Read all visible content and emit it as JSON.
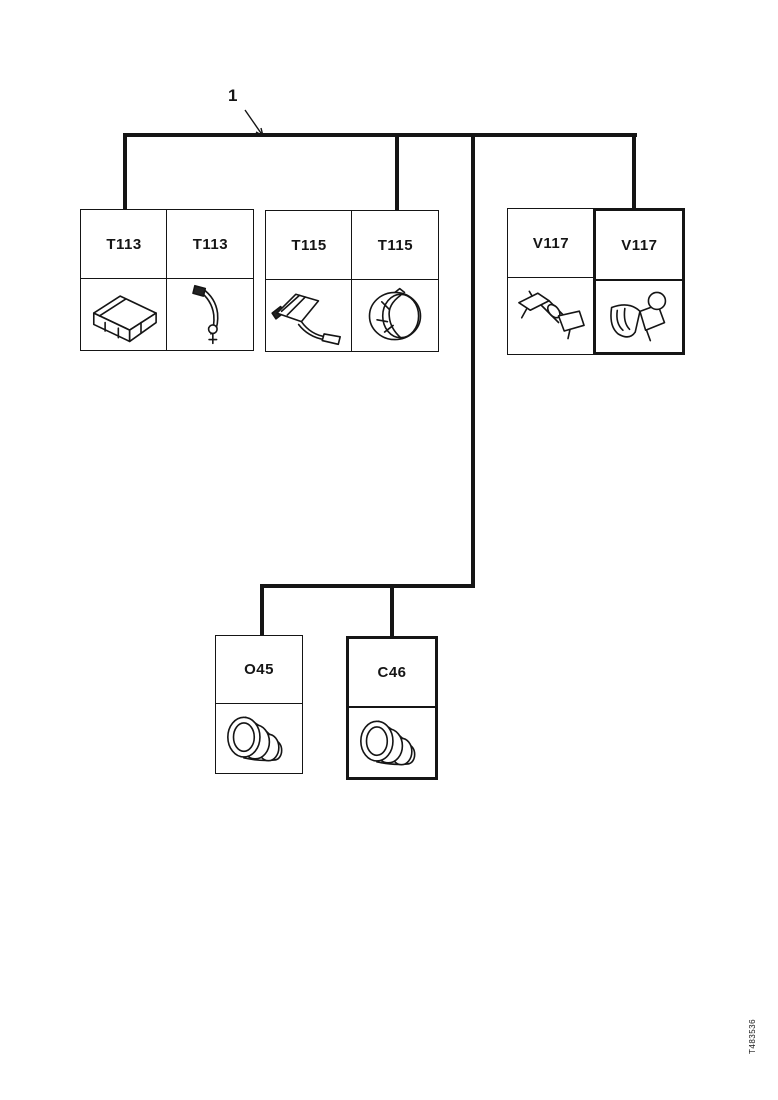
{
  "page": {
    "background": "#ffffff",
    "ink": "#151515"
  },
  "callout": {
    "label": "1"
  },
  "connector_groups": [
    {
      "name": "T113",
      "cells": [
        {
          "label": "T113",
          "icon": "rectangular-connector-icon"
        },
        {
          "label": "T113",
          "icon": "cable-sensor-icon"
        }
      ]
    },
    {
      "name": "T115",
      "cells": [
        {
          "label": "T115",
          "icon": "bracket-sensor-icon"
        },
        {
          "label": "T115",
          "icon": "round-connector-icon"
        }
      ]
    },
    {
      "name": "V117",
      "cells": [
        {
          "label": "V117",
          "icon": "valve-assembly-icon"
        },
        {
          "label": "V117",
          "icon": "solenoid-valve-icon"
        }
      ]
    }
  ],
  "lower_boxes": [
    {
      "label": "O45",
      "icon": "cylindrical-connector-icon"
    },
    {
      "label": "C46",
      "icon": "cylindrical-connector-icon"
    }
  ],
  "footer": {
    "drawing_code": "T483536"
  }
}
